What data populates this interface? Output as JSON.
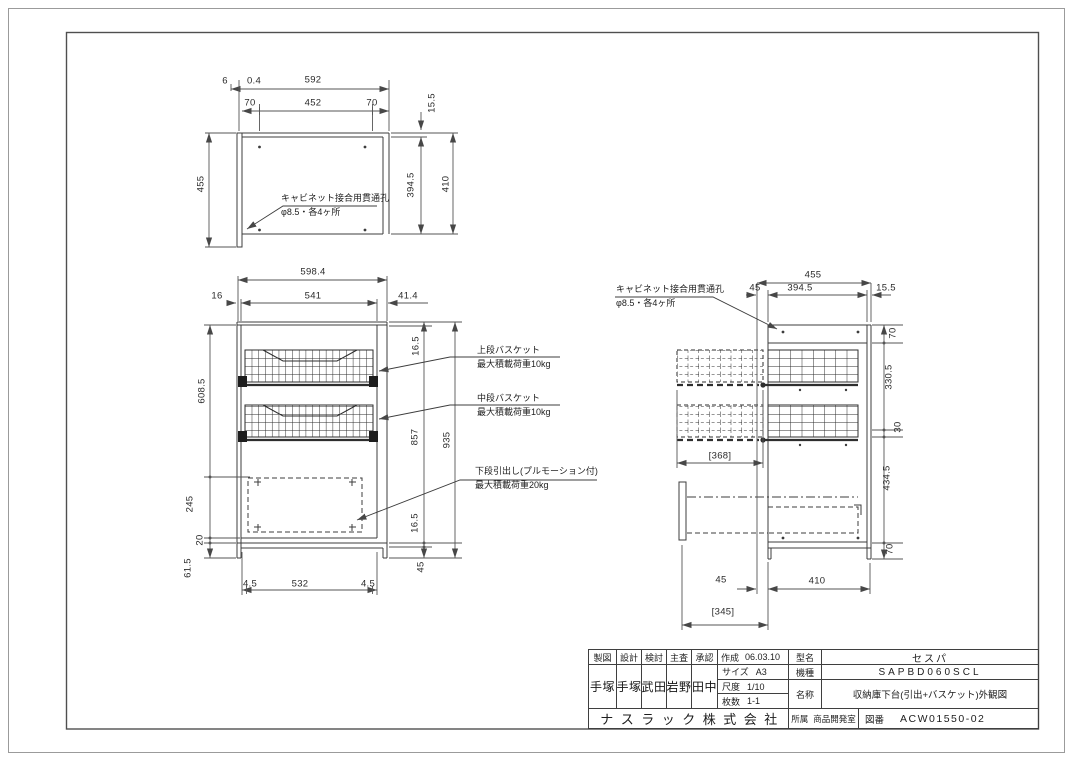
{
  "drawing": {
    "views": {
      "top_view": {
        "dim_labels": [
          {
            "t": "6",
            "x": 225,
            "y": 81
          },
          {
            "t": "0.4",
            "x": 254,
            "y": 81
          },
          {
            "t": "592",
            "x": 313,
            "y": 80
          },
          {
            "t": "70",
            "x": 250,
            "y": 103
          },
          {
            "t": "452",
            "x": 313,
            "y": 103
          },
          {
            "t": "70",
            "x": 372,
            "y": 103
          },
          {
            "t": "455",
            "x": 201,
            "y": 184,
            "r": 1
          },
          {
            "t": "15.5",
            "x": 432,
            "y": 103,
            "r": 1
          },
          {
            "t": "394.5",
            "x": 411,
            "y": 185,
            "r": 1
          },
          {
            "t": "410",
            "x": 446,
            "y": 184,
            "r": 1
          }
        ],
        "callouts": [
          {
            "lines": [
              "キャビネット接合用貫通孔",
              "φ8.5・各4ヶ所"
            ],
            "x": 281,
            "y": 192
          }
        ]
      },
      "front_view": {
        "dim_labels": [
          {
            "t": "598.4",
            "x": 313,
            "y": 272
          },
          {
            "t": "16",
            "x": 217,
            "y": 296
          },
          {
            "t": "541",
            "x": 313,
            "y": 296
          },
          {
            "t": "41.4",
            "x": 408,
            "y": 296
          },
          {
            "t": "608.5",
            "x": 202,
            "y": 391,
            "r": 1
          },
          {
            "t": "245",
            "x": 190,
            "y": 504,
            "r": 1
          },
          {
            "t": "20",
            "x": 200,
            "y": 540,
            "r": 1
          },
          {
            "t": "61.5",
            "x": 188,
            "y": 568,
            "r": 1
          },
          {
            "t": "4.5",
            "x": 250,
            "y": 584
          },
          {
            "t": "532",
            "x": 300,
            "y": 584
          },
          {
            "t": "4.5",
            "x": 368,
            "y": 584
          },
          {
            "t": "16.5",
            "x": 416,
            "y": 346,
            "r": 1
          },
          {
            "t": "857",
            "x": 415,
            "y": 437,
            "r": 1
          },
          {
            "t": "935",
            "x": 447,
            "y": 440,
            "r": 1
          },
          {
            "t": "16.5",
            "x": 415,
            "y": 523,
            "r": 1
          },
          {
            "t": "45",
            "x": 421,
            "y": 567,
            "r": 1
          }
        ],
        "callouts": [
          {
            "lines": [
              "上段バスケット",
              "最大積載荷重10kg"
            ],
            "x": 477,
            "y": 344
          },
          {
            "lines": [
              "中段バスケット",
              "最大積載荷重10kg"
            ],
            "x": 477,
            "y": 392
          },
          {
            "lines": [
              "下段引出し(プルモーション付)",
              "最大積載荷重20kg"
            ],
            "x": 475,
            "y": 465
          }
        ]
      },
      "side_view": {
        "dim_labels": [
          {
            "t": "455",
            "x": 813,
            "y": 275
          },
          {
            "t": "45",
            "x": 755,
            "y": 288
          },
          {
            "t": "394.5",
            "x": 800,
            "y": 288
          },
          {
            "t": "15.5",
            "x": 886,
            "y": 288
          },
          {
            "t": "70",
            "x": 893,
            "y": 333,
            "r": 1
          },
          {
            "t": "330.5",
            "x": 889,
            "y": 377,
            "r": 1
          },
          {
            "t": "30",
            "x": 898,
            "y": 427,
            "r": 1
          },
          {
            "t": "434.5",
            "x": 887,
            "y": 478,
            "r": 1
          },
          {
            "t": "70",
            "x": 890,
            "y": 549,
            "r": 1
          },
          {
            "t": "[368]",
            "x": 720,
            "y": 456
          },
          {
            "t": "45",
            "x": 721,
            "y": 580
          },
          {
            "t": "410",
            "x": 817,
            "y": 581
          },
          {
            "t": "[345]",
            "x": 723,
            "y": 612
          }
        ],
        "callouts": [
          {
            "lines": [
              "キャビネット接合用貫通孔",
              "φ8.5・各4ヶ所"
            ],
            "x": 616,
            "y": 283
          }
        ]
      }
    },
    "title_block": {
      "approval_columns": [
        {
          "header": "製図",
          "stamp": "手塚"
        },
        {
          "header": "設計",
          "stamp": "手塚"
        },
        {
          "header": "検討",
          "stamp": "武田"
        },
        {
          "header": "主査",
          "stamp": "岩野"
        },
        {
          "header": "承認",
          "stamp": "田中"
        }
      ],
      "created": {
        "label": "作成",
        "value": "06.03.10"
      },
      "size": {
        "label": "サイズ",
        "value": "A3"
      },
      "scale": {
        "label": "尺度",
        "value": "1/10"
      },
      "sheets": {
        "label": "枚数",
        "value": "1-1"
      },
      "model": {
        "label": "型名",
        "value": "セスパ"
      },
      "product_code": {
        "label": "機種",
        "value": "SAPBD060SCL"
      },
      "name": {
        "label": "名称",
        "value": "収納庫下台(引出+バスケット)外観図"
      },
      "company": "ナスラック株式会社",
      "department": {
        "label": "所属",
        "value": "商品開発室"
      },
      "drawing_number": {
        "label": "図番",
        "value": "ACW01550-02"
      }
    },
    "colors": {
      "line": "#3c3c3c",
      "dim_line": "#565656",
      "background": "#ffffff"
    }
  }
}
